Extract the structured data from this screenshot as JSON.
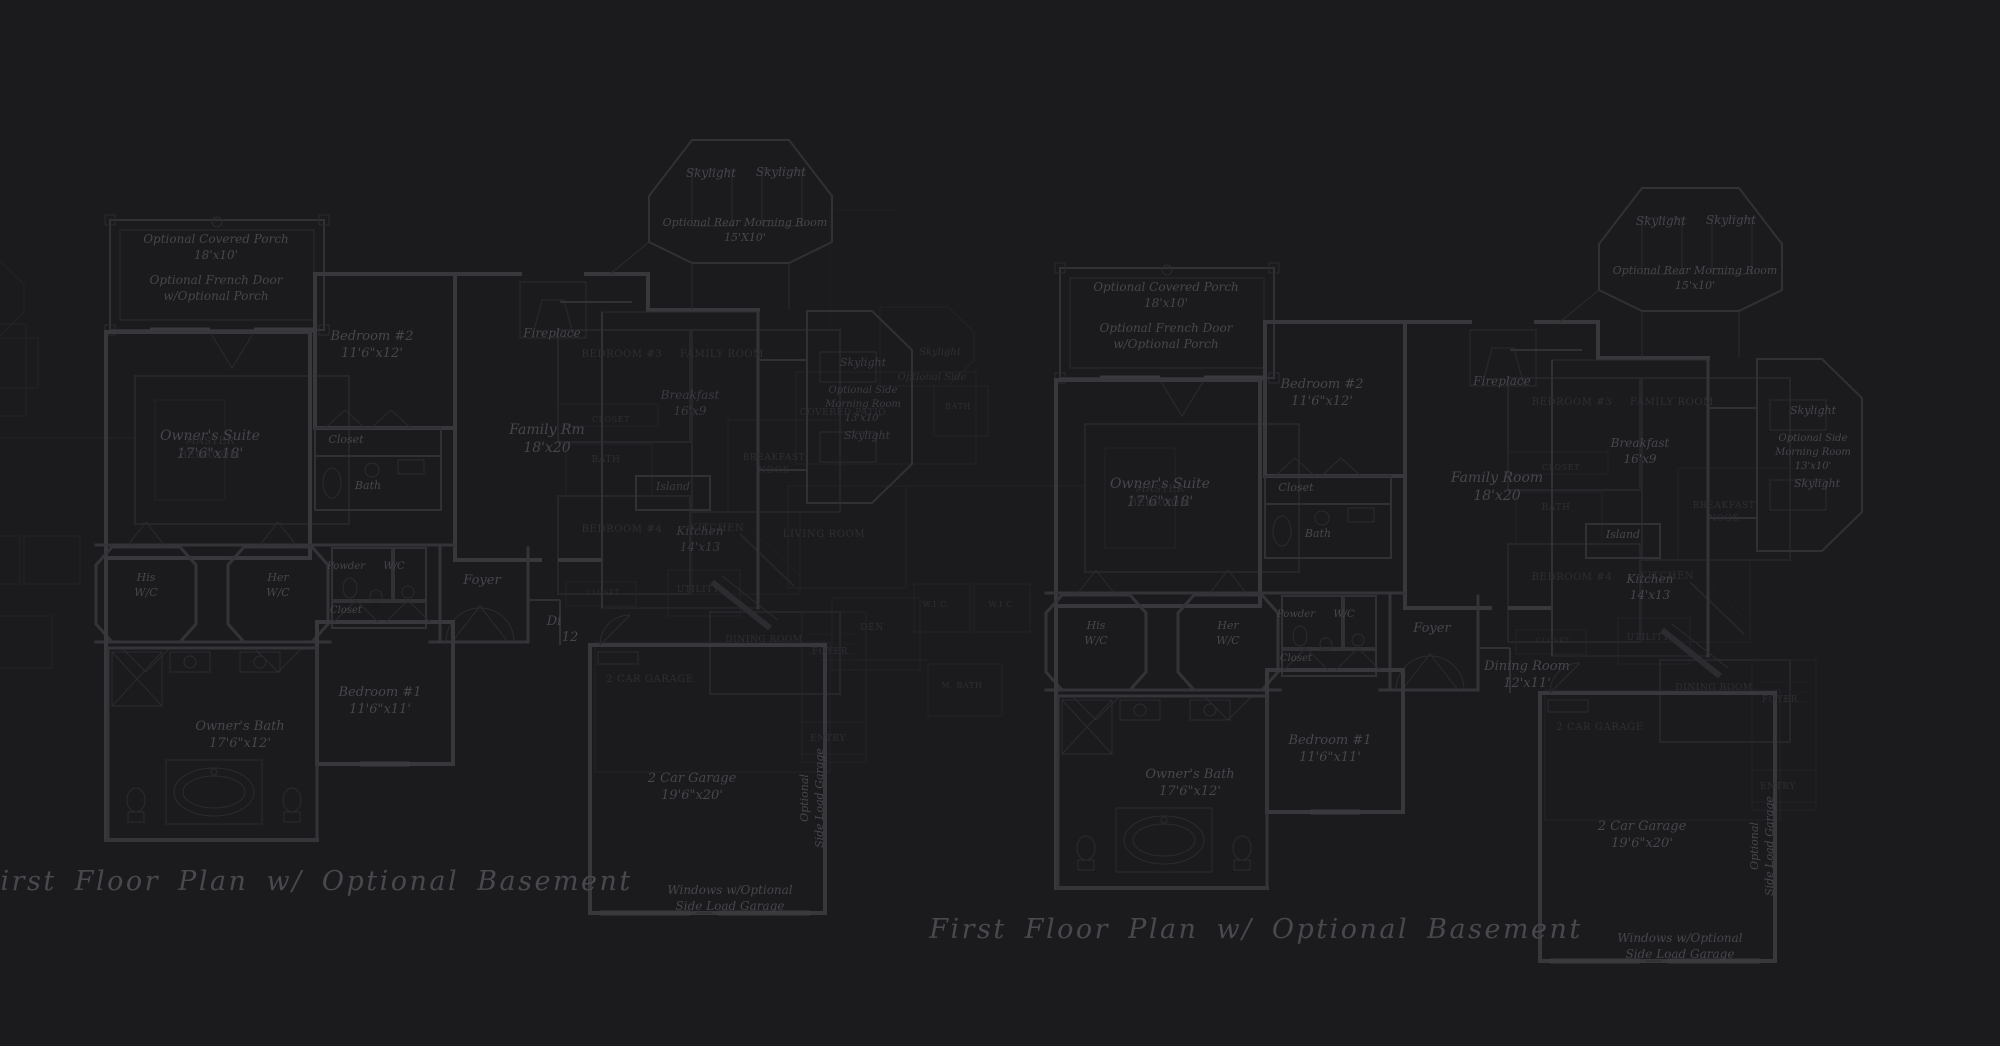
{
  "document": {
    "type": "architectural floor plan blueprint",
    "sheet_background": "#1b1a1c",
    "bright_line_color": "#38373b",
    "ghost_line_color": "#26252a",
    "bright_text_color": "#47464d",
    "ghost_text_color": "#2f2e34",
    "title_text": "First Floor Plan  w/ Optional Basement"
  },
  "labels": [
    {
      "n": "porch-label-left",
      "x": 216,
      "y": 243,
      "s": 12,
      "ly": "b",
      "t": [
        "Optional Covered Porch",
        "18'x10'"
      ]
    },
    {
      "n": "french-door-label-left",
      "x": 216,
      "y": 284,
      "s": 12,
      "ly": "b",
      "t": [
        "Optional French Door",
        "w/Optional Porch"
      ]
    },
    {
      "n": "owners-suite-left",
      "x": 210,
      "y": 440,
      "s": 14,
      "ly": "b",
      "t": [
        "Owner's Suite",
        "17'6\"x18'"
      ]
    },
    {
      "n": "bedroom2-left",
      "x": 372,
      "y": 340,
      "s": 13,
      "ly": "b",
      "t": [
        "Bedroom #2",
        "11'6\"x12'"
      ]
    },
    {
      "n": "closet-bedroom2-left",
      "x": 346,
      "y": 443,
      "s": 11,
      "ly": "b",
      "t": [
        "Closet"
      ]
    },
    {
      "n": "bath-bedroom2-left",
      "x": 368,
      "y": 489,
      "s": 11,
      "ly": "b",
      "t": [
        "Bath"
      ]
    },
    {
      "n": "fireplace-left",
      "x": 552,
      "y": 337,
      "s": 12,
      "ly": "b",
      "t": [
        "Fireplace"
      ]
    },
    {
      "n": "family-room-left",
      "x": 547,
      "y": 434,
      "s": 14,
      "ly": "b",
      "t": [
        "Family Rm",
        "18'x20"
      ]
    },
    {
      "n": "skylight-rear-1-left",
      "x": 711,
      "y": 177,
      "s": 12,
      "ly": "b",
      "t": [
        "Skylight"
      ]
    },
    {
      "n": "skylight-rear-2-left",
      "x": 781,
      "y": 176,
      "s": 12,
      "ly": "b",
      "t": [
        "Skylight"
      ]
    },
    {
      "n": "rear-morning-room-left",
      "x": 745,
      "y": 226,
      "s": 11,
      "ly": "b",
      "t": [
        "Optional Rear Morning Room",
        "15'X10'"
      ]
    },
    {
      "n": "breakfast-left",
      "x": 690,
      "y": 399,
      "s": 12,
      "ly": "d",
      "t": [
        "Breakfast",
        "16'x9"
      ]
    },
    {
      "n": "island-left",
      "x": 673,
      "y": 490,
      "s": 11,
      "ly": "d",
      "t": [
        "Island"
      ]
    },
    {
      "n": "kitchen-left",
      "x": 700,
      "y": 535,
      "s": 12,
      "ly": "d",
      "t": [
        "Kitchen",
        "14'x13"
      ]
    },
    {
      "n": "skylight-side-top-left",
      "x": 863,
      "y": 366,
      "s": 11,
      "ly": "d",
      "t": [
        "Skylight"
      ]
    },
    {
      "n": "side-morning-room-left",
      "x": 863,
      "y": 393,
      "s": 10,
      "ly": "d",
      "t": [
        "Optional Side",
        "Morning Room",
        "13'x10'"
      ]
    },
    {
      "n": "skylight-side-bottom-left",
      "x": 867,
      "y": 439,
      "s": 11,
      "ly": "d",
      "t": [
        "Skylight"
      ]
    },
    {
      "n": "his-wc-left",
      "x": 146,
      "y": 581,
      "s": 11,
      "ly": "b",
      "t": [
        "His",
        "W/C"
      ]
    },
    {
      "n": "her-wc-left",
      "x": 278,
      "y": 581,
      "s": 11,
      "ly": "b",
      "t": [
        "Her",
        "W/C"
      ]
    },
    {
      "n": "powder-left",
      "x": 346,
      "y": 569,
      "s": 10,
      "ly": "b",
      "t": [
        "Powder"
      ]
    },
    {
      "n": "wc-left",
      "x": 394,
      "y": 569,
      "s": 10,
      "ly": "b",
      "t": [
        "W/C"
      ]
    },
    {
      "n": "closet-hall-left",
      "x": 346,
      "y": 613,
      "s": 10,
      "ly": "b",
      "t": [
        "Closet"
      ]
    },
    {
      "n": "foyer-left",
      "x": 482,
      "y": 584,
      "s": 13,
      "ly": "b",
      "t": [
        "Foyer"
      ]
    },
    {
      "n": "dining-clipped-1-left",
      "x": 554,
      "y": 625,
      "s": 13,
      "ly": "b",
      "t": [
        "Di"
      ]
    },
    {
      "n": "dining-clipped-2-left",
      "x": 570,
      "y": 641,
      "s": 13,
      "ly": "b",
      "t": [
        "12"
      ]
    },
    {
      "n": "bedroom1-left",
      "x": 380,
      "y": 696,
      "s": 13,
      "ly": "b",
      "t": [
        "Bedroom #1",
        "11'6\"x11'"
      ]
    },
    {
      "n": "owners-bath-left",
      "x": 240,
      "y": 730,
      "s": 13,
      "ly": "b",
      "t": [
        "Owner's Bath",
        "17'6\"x12'"
      ]
    },
    {
      "n": "garage-left",
      "x": 692,
      "y": 782,
      "s": 13,
      "ly": "b",
      "t": [
        "2 Car Garage",
        "19'6\"x20'"
      ]
    },
    {
      "n": "side-load-vert-left",
      "x": 808,
      "y": 798,
      "s": 11,
      "ly": "b",
      "r": -90,
      "t": [
        "Optional",
        "Side Load Garage"
      ]
    },
    {
      "n": "windows-optional-left",
      "x": 730,
      "y": 894,
      "s": 12,
      "ly": "b",
      "t": [
        "Windows w/Optional",
        "Side Load Garage"
      ]
    },
    {
      "n": "plan-title-left",
      "x": 306,
      "y": 890,
      "s": 27,
      "ly": "t",
      "t": [
        "First Floor Plan  w/ Optional Basement"
      ]
    },
    {
      "n": "ghost-bedroom3-left",
      "x": 622,
      "y": 357,
      "s": 10,
      "ly": "u",
      "t": [
        "BEDROOM #3"
      ]
    },
    {
      "n": "ghost-familyroom-left",
      "x": 722,
      "y": 357,
      "s": 10,
      "ly": "u",
      "t": [
        "FAMILY ROOM"
      ]
    },
    {
      "n": "ghost-closet-left",
      "x": 611,
      "y": 422,
      "s": 8,
      "ly": "u",
      "t": [
        "CLOSET"
      ]
    },
    {
      "n": "ghost-bath-left",
      "x": 606,
      "y": 462,
      "s": 9,
      "ly": "u",
      "t": [
        "BATH"
      ]
    },
    {
      "n": "ghost-breakfast-nook-left",
      "x": 774,
      "y": 460,
      "s": 9,
      "ly": "u",
      "t": [
        "BREAKFAST",
        "NOOK"
      ]
    },
    {
      "n": "ghost-bedroom4-left",
      "x": 622,
      "y": 532,
      "s": 10,
      "ly": "u",
      "t": [
        "BEDROOM #4"
      ]
    },
    {
      "n": "ghost-kitchen-left",
      "x": 717,
      "y": 531,
      "s": 10,
      "ly": "u",
      "t": [
        "KITCHEN"
      ]
    },
    {
      "n": "ghost-utility-left",
      "x": 698,
      "y": 592,
      "s": 9,
      "ly": "u",
      "t": [
        "UTILITY"
      ]
    },
    {
      "n": "ghost-closet2-left",
      "x": 603,
      "y": 595,
      "s": 7,
      "ly": "u",
      "t": [
        "CLOSET"
      ]
    },
    {
      "n": "ghost-dining-left",
      "x": 764,
      "y": 642,
      "s": 9,
      "ly": "u",
      "t": [
        "DINING ROOM"
      ]
    },
    {
      "n": "ghost-foyer-left",
      "x": 830,
      "y": 654,
      "s": 9,
      "ly": "u",
      "t": [
        "FOYER"
      ]
    },
    {
      "n": "ghost-entry-left",
      "x": 828,
      "y": 741,
      "s": 9,
      "ly": "u",
      "t": [
        "ENTRY"
      ]
    },
    {
      "n": "ghost-garage-left",
      "x": 650,
      "y": 682,
      "s": 10,
      "ly": "u",
      "t": [
        "2 CAR GARAGE"
      ]
    },
    {
      "n": "ghost-master-left",
      "x": 210,
      "y": 444,
      "s": 10,
      "ly": "u",
      "t": [
        "MASTER",
        "BEDROOM"
      ]
    },
    {
      "n": "porch-label-right",
      "x": 1166,
      "y": 291,
      "s": 12,
      "ly": "b",
      "t": [
        "Optional Covered Porch",
        "18'x10'"
      ]
    },
    {
      "n": "french-door-label-right",
      "x": 1166,
      "y": 332,
      "s": 12,
      "ly": "b",
      "t": [
        "Optional French Door",
        "w/Optional Porch"
      ]
    },
    {
      "n": "owners-suite-right",
      "x": 1160,
      "y": 488,
      "s": 14,
      "ly": "b",
      "t": [
        "Owner's Suite",
        "17'6\"x18'"
      ]
    },
    {
      "n": "bedroom2-right",
      "x": 1322,
      "y": 388,
      "s": 13,
      "ly": "b",
      "t": [
        "Bedroom #2",
        "11'6\"x12'"
      ]
    },
    {
      "n": "closet-bedroom2-right",
      "x": 1296,
      "y": 491,
      "s": 11,
      "ly": "b",
      "t": [
        "Closet"
      ]
    },
    {
      "n": "bath-bedroom2-right",
      "x": 1318,
      "y": 537,
      "s": 11,
      "ly": "b",
      "t": [
        "Bath"
      ]
    },
    {
      "n": "fireplace-right",
      "x": 1502,
      "y": 385,
      "s": 12,
      "ly": "b",
      "t": [
        "Fireplace"
      ]
    },
    {
      "n": "family-room-right",
      "x": 1497,
      "y": 482,
      "s": 14,
      "ly": "b",
      "t": [
        "Family Room",
        "18'x20"
      ]
    },
    {
      "n": "skylight-rear-1-right",
      "x": 1661,
      "y": 225,
      "s": 12,
      "ly": "b",
      "t": [
        "Skylight"
      ]
    },
    {
      "n": "skylight-rear-2-right",
      "x": 1731,
      "y": 224,
      "s": 12,
      "ly": "b",
      "t": [
        "Skylight"
      ]
    },
    {
      "n": "rear-morning-room-right",
      "x": 1695,
      "y": 274,
      "s": 11,
      "ly": "b",
      "t": [
        "Optional Rear Morning Room",
        "15'x10'"
      ]
    },
    {
      "n": "breakfast-right",
      "x": 1640,
      "y": 447,
      "s": 12,
      "ly": "b",
      "t": [
        "Breakfast",
        "16'x9"
      ]
    },
    {
      "n": "island-right",
      "x": 1623,
      "y": 538,
      "s": 11,
      "ly": "b",
      "t": [
        "Island"
      ]
    },
    {
      "n": "kitchen-right",
      "x": 1650,
      "y": 583,
      "s": 12,
      "ly": "b",
      "t": [
        "Kitchen",
        "14'x13"
      ]
    },
    {
      "n": "skylight-side-top-right",
      "x": 1813,
      "y": 414,
      "s": 11,
      "ly": "b",
      "t": [
        "Skylight"
      ]
    },
    {
      "n": "side-morning-room-right",
      "x": 1813,
      "y": 441,
      "s": 10,
      "ly": "b",
      "t": [
        "Optional Side",
        "Morning Room",
        "13'x10'"
      ]
    },
    {
      "n": "skylight-side-bottom-right",
      "x": 1817,
      "y": 487,
      "s": 11,
      "ly": "b",
      "t": [
        "Skylight"
      ]
    },
    {
      "n": "his-wc-right",
      "x": 1096,
      "y": 629,
      "s": 11,
      "ly": "b",
      "t": [
        "His",
        "W/C"
      ]
    },
    {
      "n": "her-wc-right",
      "x": 1228,
      "y": 629,
      "s": 11,
      "ly": "b",
      "t": [
        "Her",
        "W/C"
      ]
    },
    {
      "n": "powder-right",
      "x": 1296,
      "y": 617,
      "s": 10,
      "ly": "b",
      "t": [
        "Powder"
      ]
    },
    {
      "n": "wc-right",
      "x": 1344,
      "y": 617,
      "s": 10,
      "ly": "b",
      "t": [
        "W/C"
      ]
    },
    {
      "n": "closet-hall-right",
      "x": 1296,
      "y": 661,
      "s": 10,
      "ly": "b",
      "t": [
        "Closet"
      ]
    },
    {
      "n": "foyer-right",
      "x": 1432,
      "y": 632,
      "s": 13,
      "ly": "b",
      "t": [
        "Foyer"
      ]
    },
    {
      "n": "dining-room-right",
      "x": 1527,
      "y": 670,
      "s": 13,
      "ly": "b",
      "t": [
        "Dining Room",
        "12'x11'"
      ]
    },
    {
      "n": "bedroom1-right",
      "x": 1330,
      "y": 744,
      "s": 13,
      "ly": "b",
      "t": [
        "Bedroom #1",
        "11'6\"x11'"
      ]
    },
    {
      "n": "owners-bath-right",
      "x": 1190,
      "y": 778,
      "s": 13,
      "ly": "b",
      "t": [
        "Owner's Bath",
        "17'6\"x12'"
      ]
    },
    {
      "n": "garage-right",
      "x": 1642,
      "y": 830,
      "s": 13,
      "ly": "b",
      "t": [
        "2 Car Garage",
        "19'6\"x20'"
      ]
    },
    {
      "n": "side-load-vert-right",
      "x": 1758,
      "y": 846,
      "s": 11,
      "ly": "b",
      "r": -90,
      "t": [
        "Optional",
        "Side Load Garage"
      ]
    },
    {
      "n": "windows-optional-right",
      "x": 1680,
      "y": 942,
      "s": 12,
      "ly": "b",
      "t": [
        "Windows w/Optional",
        "Side Load Garage"
      ]
    },
    {
      "n": "plan-title-right",
      "x": 1256,
      "y": 938,
      "s": 27,
      "ly": "t",
      "t": [
        "First Floor Plan  w/ Optional Basement"
      ]
    },
    {
      "n": "ghost-bedroom3-right",
      "x": 1572,
      "y": 405,
      "s": 10,
      "ly": "u",
      "t": [
        "BEDROOM #3"
      ]
    },
    {
      "n": "ghost-familyroom-right",
      "x": 1672,
      "y": 405,
      "s": 10,
      "ly": "u",
      "t": [
        "FAMILY ROOM"
      ]
    },
    {
      "n": "ghost-closet-right",
      "x": 1561,
      "y": 470,
      "s": 8,
      "ly": "u",
      "t": [
        "CLOSET"
      ]
    },
    {
      "n": "ghost-bath-right",
      "x": 1556,
      "y": 510,
      "s": 9,
      "ly": "u",
      "t": [
        "BATH"
      ]
    },
    {
      "n": "ghost-breakfast-nook-right",
      "x": 1724,
      "y": 508,
      "s": 9,
      "ly": "u",
      "t": [
        "BREAKFAST",
        "NOOK"
      ]
    },
    {
      "n": "ghost-bedroom4-right",
      "x": 1572,
      "y": 580,
      "s": 10,
      "ly": "u",
      "t": [
        "BEDROOM #4"
      ]
    },
    {
      "n": "ghost-kitchen-right",
      "x": 1667,
      "y": 579,
      "s": 10,
      "ly": "u",
      "t": [
        "KITCHEN"
      ]
    },
    {
      "n": "ghost-utility-right",
      "x": 1648,
      "y": 640,
      "s": 9,
      "ly": "u",
      "t": [
        "UTILITY"
      ]
    },
    {
      "n": "ghost-closet2-right",
      "x": 1553,
      "y": 643,
      "s": 7,
      "ly": "u",
      "t": [
        "CLOSET"
      ]
    },
    {
      "n": "ghost-dining-right",
      "x": 1714,
      "y": 690,
      "s": 9,
      "ly": "u",
      "t": [
        "DINING ROOM"
      ]
    },
    {
      "n": "ghost-foyer-right",
      "x": 1780,
      "y": 702,
      "s": 9,
      "ly": "u",
      "t": [
        "FOYER"
      ]
    },
    {
      "n": "ghost-entry-right",
      "x": 1778,
      "y": 789,
      "s": 9,
      "ly": "u",
      "t": [
        "ENTRY"
      ]
    },
    {
      "n": "ghost-garage-right",
      "x": 1600,
      "y": 730,
      "s": 10,
      "ly": "u",
      "t": [
        "2 CAR GARAGE"
      ]
    },
    {
      "n": "ghost-master-right",
      "x": 1160,
      "y": 492,
      "s": 10,
      "ly": "u",
      "t": [
        "MASTER",
        "BEDROOM"
      ]
    },
    {
      "n": "ghost-den-right",
      "x": 872,
      "y": 630,
      "s": 9,
      "ly": "u",
      "t": [
        "DEN"
      ]
    },
    {
      "n": "ghost-wic1-right",
      "x": 936,
      "y": 607,
      "s": 8,
      "ly": "u",
      "t": [
        "W.I.C."
      ]
    },
    {
      "n": "ghost-wic2-right",
      "x": 1002,
      "y": 607,
      "s": 8,
      "ly": "u",
      "t": [
        "W.I.C."
      ]
    },
    {
      "n": "ghost-mbath-right",
      "x": 962,
      "y": 688,
      "s": 8,
      "ly": "u",
      "t": [
        "M. BATH"
      ]
    },
    {
      "n": "ghost-bath-top-right",
      "x": 958,
      "y": 409,
      "s": 8,
      "ly": "u",
      "t": [
        "BATH"
      ]
    },
    {
      "n": "ghost-covered-patio-right",
      "x": 843,
      "y": 415,
      "s": 9,
      "ly": "u",
      "t": [
        "COVERED PATIO"
      ]
    },
    {
      "n": "ghost-living-room-right",
      "x": 824,
      "y": 537,
      "s": 10,
      "ly": "u",
      "t": [
        "LIVING ROOM"
      ]
    },
    {
      "n": "ghost-skylight-right",
      "x": 940,
      "y": 355,
      "s": 10,
      "ly": "ui",
      "t": [
        "Skylight"
      ]
    },
    {
      "n": "ghost-opt-side-right",
      "x": 932,
      "y": 380,
      "s": 10,
      "ly": "ui",
      "t": [
        "Optional Side"
      ]
    }
  ]
}
